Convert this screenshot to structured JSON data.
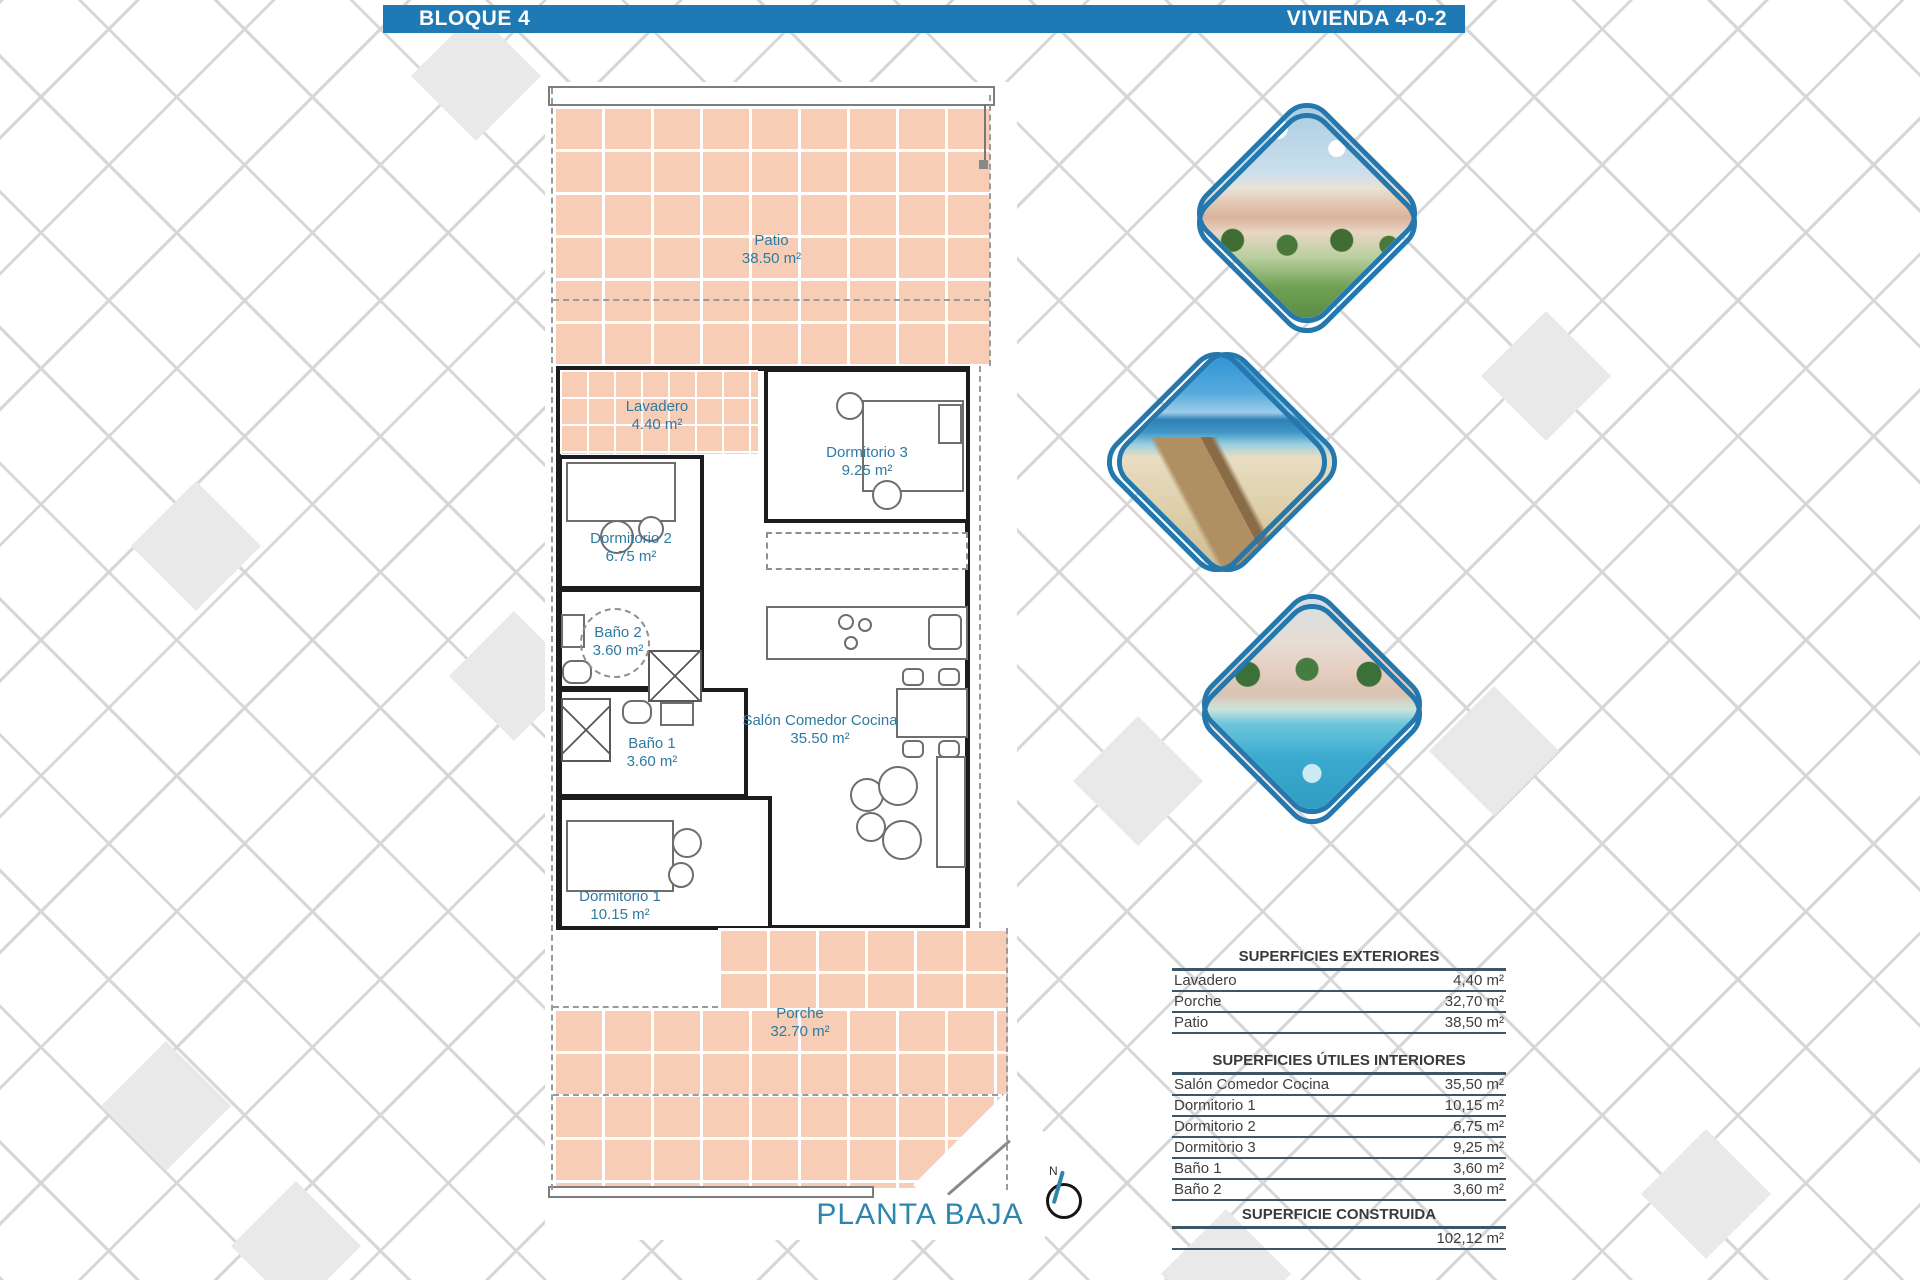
{
  "header": {
    "left": "BLOQUE 4",
    "right": "VIVIENDA 4-0-2"
  },
  "plan": {
    "title": "PLANTA BAJA",
    "compass_label": "N",
    "rooms": [
      {
        "id": "patio",
        "name": "Patio",
        "area": "38.50 m²"
      },
      {
        "id": "lavadero",
        "name": "Lavadero",
        "area": "4.40 m²"
      },
      {
        "id": "dormitorio3",
        "name": "Dormitorio 3",
        "area": "9.25 m²"
      },
      {
        "id": "dormitorio2",
        "name": "Dormitorio 2",
        "area": "6.75 m²"
      },
      {
        "id": "bano2",
        "name": "Baño 2",
        "area": "3.60 m²"
      },
      {
        "id": "bano1",
        "name": "Baño 1",
        "area": "3.60 m²"
      },
      {
        "id": "salon",
        "name": "Salón Comedor Cocina",
        "area": "35.50 m²"
      },
      {
        "id": "dormitorio1",
        "name": "Dormitorio 1",
        "area": "10.15 m²"
      },
      {
        "id": "porche",
        "name": "Porche",
        "area": "32.70 m²"
      }
    ]
  },
  "photos": [
    {
      "name": "apartments-exterior-render"
    },
    {
      "name": "beach-boardwalk"
    },
    {
      "name": "pool-and-gardens"
    }
  ],
  "tables": {
    "exteriores": {
      "title": "SUPERFICIES EXTERIORES",
      "rows": [
        {
          "label": "Lavadero",
          "value": "4,40 m²"
        },
        {
          "label": "Porche",
          "value": "32,70 m²"
        },
        {
          "label": "Patio",
          "value": "38,50 m²"
        }
      ]
    },
    "interiores": {
      "title": "SUPERFICIES ÚTILES INTERIORES",
      "rows": [
        {
          "label": "Salón Comedor Cocina",
          "value": "35,50 m²"
        },
        {
          "label": "Dormitorio 1",
          "value": "10,15 m²"
        },
        {
          "label": "Dormitorio 2",
          "value": "6,75 m²"
        },
        {
          "label": "Dormitorio 3",
          "value": "9,25 m²"
        },
        {
          "label": "Baño 1",
          "value": "3,60 m²"
        },
        {
          "label": "Baño 2",
          "value": "3,60 m²"
        }
      ]
    },
    "construida": {
      "title": "SUPERFICIE CONSTRUIDA",
      "value": "102,12 m²"
    }
  },
  "colors": {
    "accent_blue": "#1e79b4",
    "tile_salmon": "#f8cdb6",
    "label_blue": "#2f7aa2",
    "table_line": "#3d5666"
  }
}
